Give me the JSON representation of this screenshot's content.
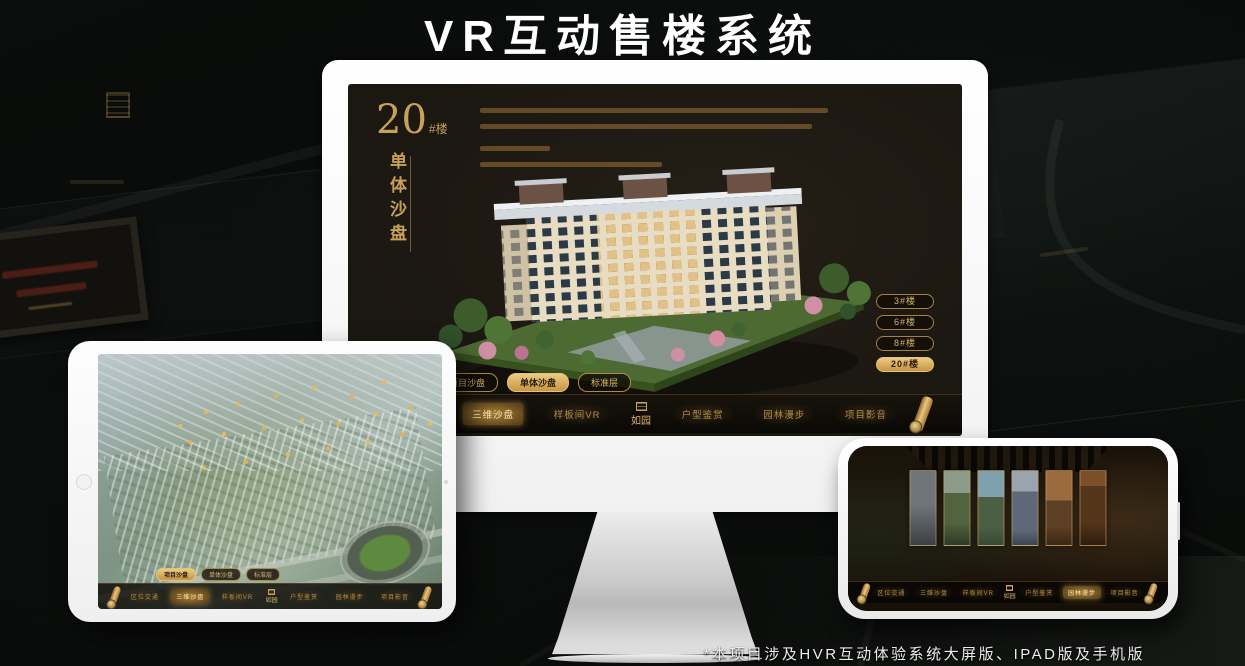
{
  "page": {
    "title": "VR互动售楼系统",
    "footnote": "*本项目涉及HVR互动体验系统大屏版、IPAD版及手机版"
  },
  "colors": {
    "gold": "#c9a05a",
    "gold_bright": "#e8c078",
    "screen_bg": "#1d1912"
  },
  "logo": {
    "text": "如园"
  },
  "nav": {
    "items": [
      "区位交通",
      "三维沙盘",
      "样板间VR",
      "户型鉴赏",
      "园林漫步",
      "项目影音"
    ]
  },
  "sub_tabs": {
    "items": [
      "项目沙盘",
      "单体沙盘",
      "标准层"
    ]
  },
  "monitor": {
    "heading": {
      "number": "20",
      "suffix": "#楼",
      "vertical": "单体沙盘"
    },
    "floor_buttons": [
      "3#楼",
      "6#楼",
      "8#楼",
      "20#楼"
    ],
    "active_floor": "20#楼",
    "active_sub_tab": "单体沙盘",
    "active_nav": "三维沙盘"
  },
  "tablet": {
    "active_sub_tab": "项目沙盘",
    "active_nav": "三维沙盘"
  },
  "phone": {
    "active_nav": "园林漫步"
  }
}
